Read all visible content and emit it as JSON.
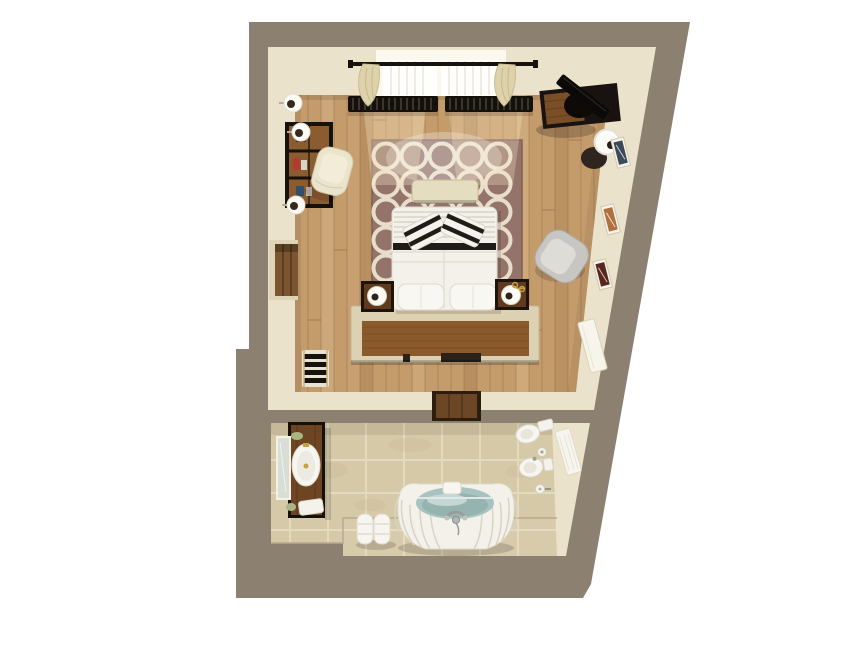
{
  "scene": {
    "description": "Top-down 3D rendered floor plan of a hotel suite with bedroom and bathroom",
    "rooms": [
      {
        "name": "bedroom",
        "objects": [
          "window with curtains",
          "curtain rod",
          "window radiators",
          "area rug with circle pattern",
          "double bed",
          "striped accent pillows",
          "white pillows",
          "foot bench",
          "headboard",
          "nightstand with lamp (left)",
          "nightstand with lamp (right)",
          "bookshelf",
          "lounge chair",
          "wall sconces",
          "closet niche",
          "towel radiator",
          "tv desk",
          "floor lamp",
          "wall art (3 frames)",
          "armchair",
          "entry door panel",
          "door threshold"
        ]
      },
      {
        "name": "bathroom",
        "objects": [
          "wood vanity with sink",
          "wall mirror",
          "soap dish",
          "bath mat",
          "rolled towel stack",
          "oval bathtub with water",
          "chrome tub faucet",
          "tub rim towel",
          "toilet",
          "toilet brush",
          "bidet",
          "toilet paper holder",
          "hanging towel",
          "raised tub platform"
        ]
      }
    ]
  },
  "palette": {
    "background": "#ffffff",
    "outer_wall": "#8c8070",
    "inner_wall": "#eae2ca",
    "wood_floor": "#c49c6c",
    "rug": "#94736a",
    "rug_ring": "#e8ddc8",
    "bed_linen": "#f3f1ea",
    "headboard_stone": "#dcd2b3",
    "headboard_wood": "#8a5a2c",
    "bench": "#e5ddc0",
    "dark_wood": "#1d130b",
    "curtain": "#ddd2a9",
    "radiator_dark": "#14100c",
    "armchair": "#c7c6c2",
    "tile": "#d6c9a7",
    "grout": "#e6dcc0",
    "water": "#a8c3bf",
    "porcelain": "#f6f5f0",
    "vanity_wood": "#6e4523",
    "chrome": "#b5b5b3",
    "gold": "#c9a040"
  }
}
